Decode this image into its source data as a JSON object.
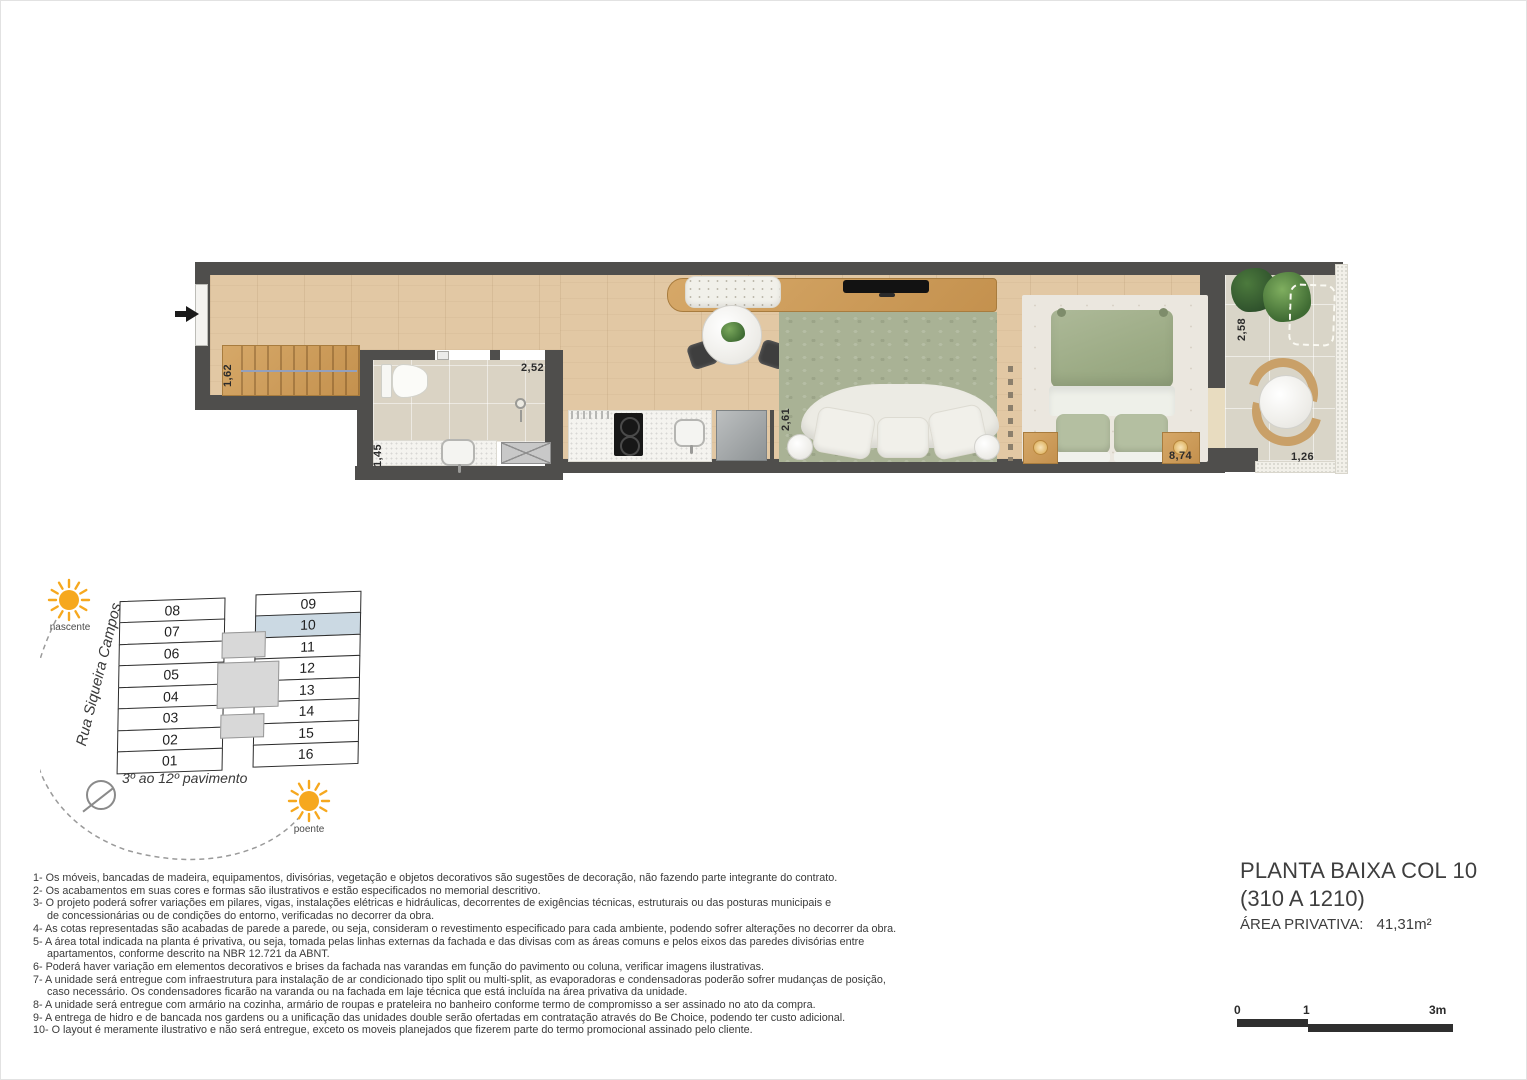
{
  "plan": {
    "dims": {
      "closet_width": "1,62",
      "bath_width": "1,45",
      "bath_length": "2,52",
      "living_width": "2,61",
      "bedroom_length": "8,74",
      "balcony_depth": "2,58",
      "balcony_width": "1,26"
    }
  },
  "keyplan": {
    "street": "Rua Siqueira Campos",
    "floors_label": "3º ao 12º pavimento",
    "sun_east_label": "nascente",
    "sun_west_label": "poente",
    "left_units": [
      "08",
      "07",
      "06",
      "05",
      "04",
      "03",
      "02",
      "01"
    ],
    "right_units": [
      "09",
      "10",
      "11",
      "12",
      "13",
      "14",
      "15",
      "16"
    ],
    "highlighted_unit": "10"
  },
  "notes": [
    {
      "text": "1- Os móveis, bancadas de madeira, equipamentos, divisórias, vegetação e objetos decorativos são sugestões de decoração, não fazendo parte integrante do contrato."
    },
    {
      "text": "2- Os acabamentos em suas cores e formas são ilustrativos e estão especificados no memorial descritivo."
    },
    {
      "text": "3- O projeto poderá sofrer variações em pilares, vigas, instalações elétricas e hidráulicas, decorrentes de exigências técnicas, estruturais ou das posturas municipais e\nde concessionárias ou de condições do entorno, verificadas no decorrer da obra."
    },
    {
      "text": "4- As cotas representadas são acabadas de parede a parede, ou seja, consideram o revestimento especificado para cada ambiente, podendo sofrer alterações no decorrer da obra."
    },
    {
      "text": "5- A área total indicada na planta é privativa, ou seja, tomada pelas linhas externas da fachada e das divisas com as áreas comuns e pelos eixos das paredes divisórias entre\napartamentos, conforme descrito na NBR 12.721 da ABNT."
    },
    {
      "text": "6- Poderá haver variação em elementos decorativos e brises da fachada nas varandas em função do pavimento ou coluna, verificar imagens ilustrativas."
    },
    {
      "text": "7- A unidade será entregue com infraestrutura para instalação de ar condicionado tipo split ou multi-split, as evaporadoras e condensadoras poderão sofrer mudanças de posição,\ncaso necessário. Os condensadores ficarão na varanda ou na fachada em laje técnica que está incluída na área privativa da unidade."
    },
    {
      "text": "8- A unidade será entregue com armário na cozinha, armário de roupas e prateleira no banheiro conforme termo de compromisso a ser assinado no ato da compra."
    },
    {
      "text": "9- A entrega de hidro e de bancada nos gardens ou a unificação das unidades double serão ofertadas em contratação através do Be Choice, podendo ter custo adicional."
    },
    {
      "text": "10- O layout é meramente ilustrativo e não será entregue, exceto os moveis planejados que fizerem parte do termo promocional assinado pelo cliente."
    }
  ],
  "title": {
    "line1": "PLANTA BAIXA COL 10",
    "line2": "(310 A 1210)",
    "area_label": "ÁREA PRIVATIVA:",
    "area_value": "41,31m²"
  },
  "scalebar": {
    "tick0": "0",
    "tick1": "1",
    "tick3": "3m"
  },
  "colors": {
    "wall": "#4f4e4c",
    "wood_floor": "#e2c8a4",
    "cabinet_wood": "#c4914e",
    "rug_green": "#a9b295",
    "duvet_green": "#a5b28f",
    "unit_highlight": "#cbd9e3",
    "sun": "#f6a81e"
  }
}
